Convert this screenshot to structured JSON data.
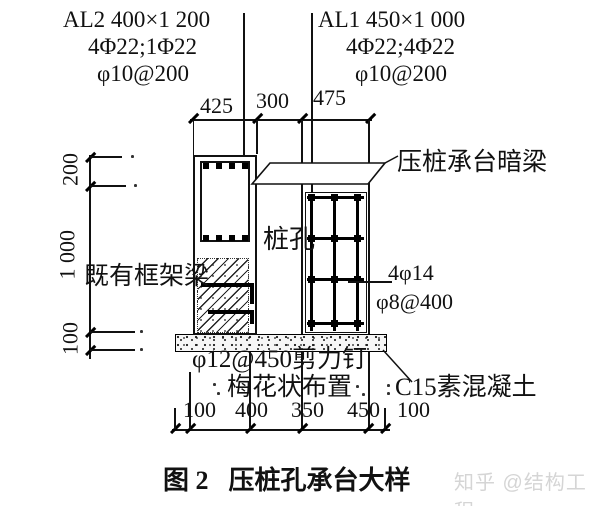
{
  "figure": {
    "caption_prefix": "图 2",
    "caption_title": "压桩孔承台大样",
    "watermark": "知乎 @结构工程"
  },
  "beam_al2": {
    "title": "AL2  400×1 200",
    "rebar": "4Φ22;1Φ22",
    "stirrup": "φ10@200"
  },
  "beam_al1": {
    "title": "AL1  450×1 000",
    "rebar": "4Φ22;4Φ22",
    "stirrup": "φ10@200"
  },
  "annotations": {
    "hidden_beam": "压桩承台暗梁",
    "pile_hole": "桩孔",
    "existing_frame_beam": "既有框架梁",
    "bottom_bars": "4φ14",
    "stirrups": "φ8@400",
    "shear_studs": "φ12@450剪力钉",
    "stud_layout": "梅花状布置",
    "plain_concrete": "C15素混凝土"
  },
  "dimensions": {
    "top": [
      "425",
      "300",
      "475"
    ],
    "left": [
      "200",
      "1 000",
      "100"
    ],
    "bottom": [
      "100",
      "400",
      "350",
      "450",
      "100"
    ]
  },
  "colors": {
    "line": "#111111",
    "watermark": "#d5d5d5"
  }
}
